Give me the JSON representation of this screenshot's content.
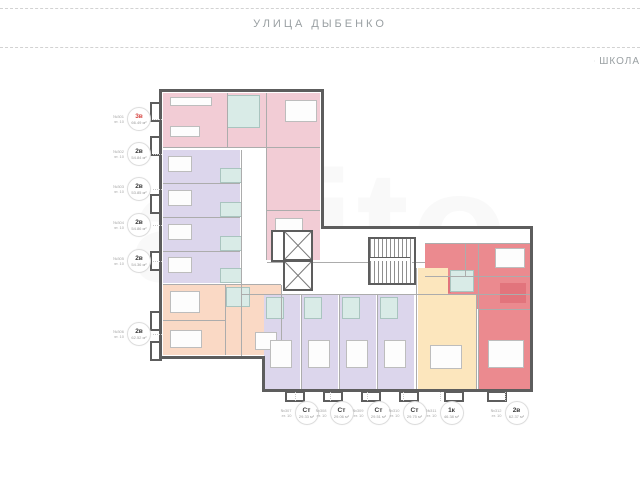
{
  "header": {
    "street": "УЛИЦА ДЫБЕНКО",
    "school": "ШКОЛА"
  },
  "watermark": "avito",
  "colors": {
    "pink": "#F2CCD5",
    "purple": "#DCD6EC",
    "red": "#EB8A8F",
    "red_dark": "#E2747C",
    "peach": "#FAD9C5",
    "yellow": "#FCE6BD",
    "teal_bath": "#D9EBE7",
    "wall": "#5D5D5D",
    "highlight_text": "#D64541"
  },
  "apartments": {
    "left": [
      {
        "num": "№301",
        "floor": "эт. 10",
        "type": "3в",
        "area": "66.49 м²"
      },
      {
        "num": "№302",
        "floor": "эт. 10",
        "type": "2в",
        "area": "54.84 м²"
      },
      {
        "num": "№303",
        "floor": "эт. 10",
        "type": "2в",
        "area": "53.85 м²"
      },
      {
        "num": "№304",
        "floor": "эт. 10",
        "type": "2в",
        "area": "54.86 м²"
      },
      {
        "num": "№305",
        "floor": "эт. 10",
        "type": "2в",
        "area": "54.36 м²"
      },
      {
        "num": "№306",
        "floor": "эт. 10",
        "type": "2в",
        "area": "62.52 м²"
      }
    ],
    "bottom": [
      {
        "num": "№307",
        "floor": "эт. 10",
        "type": "Ст",
        "area": "29.33 м²"
      },
      {
        "num": "№308",
        "floor": "эт. 10",
        "type": "Ст",
        "area": "29.06 м²"
      },
      {
        "num": "№309",
        "floor": "эт. 10",
        "type": "Ст",
        "area": "29.51 м²"
      },
      {
        "num": "№310",
        "floor": "эт. 10",
        "type": "Ст",
        "area": "29.75 м²"
      },
      {
        "num": "№311",
        "floor": "эт. 10",
        "type": "1к",
        "area": "46.38 м²"
      },
      {
        "num": "№312",
        "floor": "эт. 10",
        "type": "2в",
        "area": "62.37 м²"
      }
    ]
  }
}
